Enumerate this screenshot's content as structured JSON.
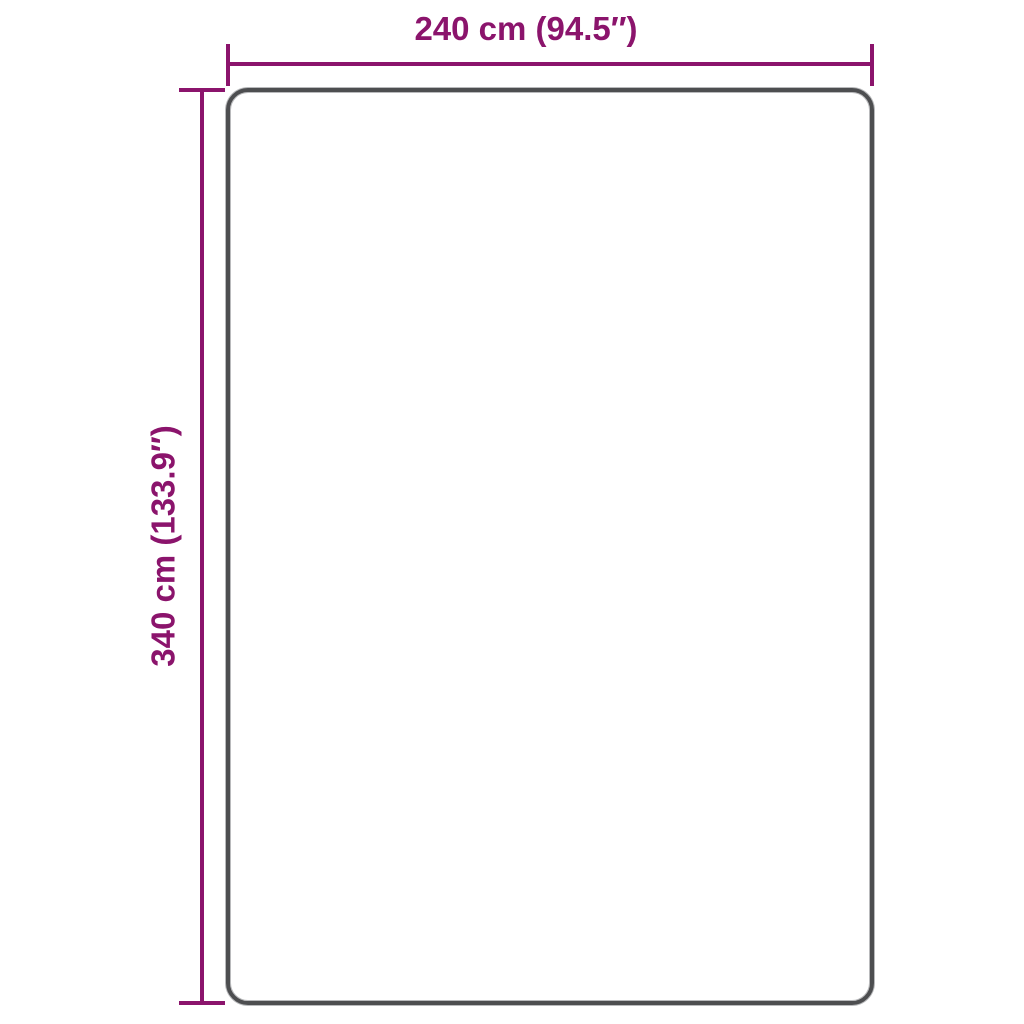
{
  "diagram": {
    "width_label": "240 cm (94.5″)",
    "height_label": "340 cm (133.9″)"
  },
  "colors": {
    "dimension": "#8B146C",
    "outline": "#4D4E50",
    "background": "#FFFFFF"
  }
}
